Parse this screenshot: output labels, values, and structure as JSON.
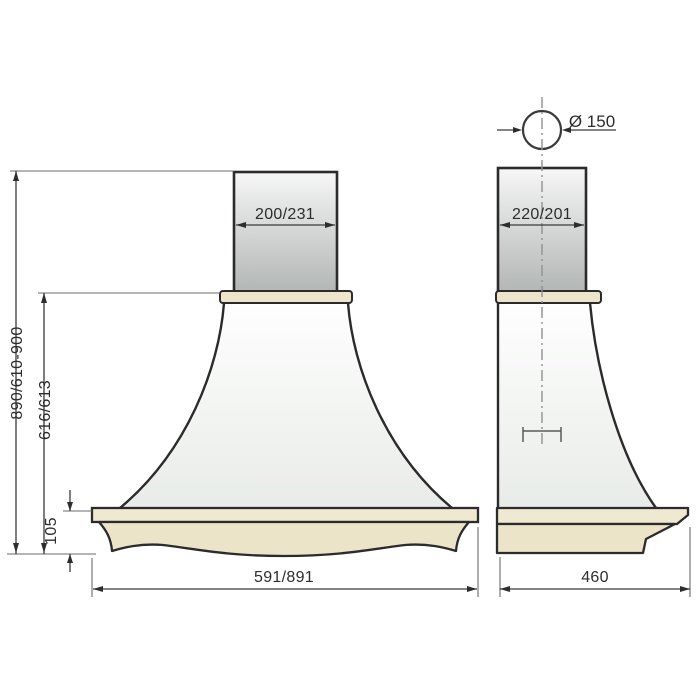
{
  "drawing": {
    "type": "cooker-hood dimensional drawing, front and side views",
    "colors": {
      "wood": "#ebe4c9",
      "outline": "#2b2b2b",
      "chimney_top": "#f6f7f6",
      "chimney_bottom": "#b2b6b4",
      "dimension_line": "#3a3a3a",
      "centerline": "#909090"
    }
  },
  "front_view": {
    "chimney_width_label": "200/231",
    "overall_height_label": "890/610-900",
    "hood_height_label": "616/613",
    "base_height_label": "105",
    "width_label": "591/891"
  },
  "side_view": {
    "chimney_depth_label": "220/201",
    "depth_label": "460",
    "duct_diameter_label": "Ø 150"
  }
}
